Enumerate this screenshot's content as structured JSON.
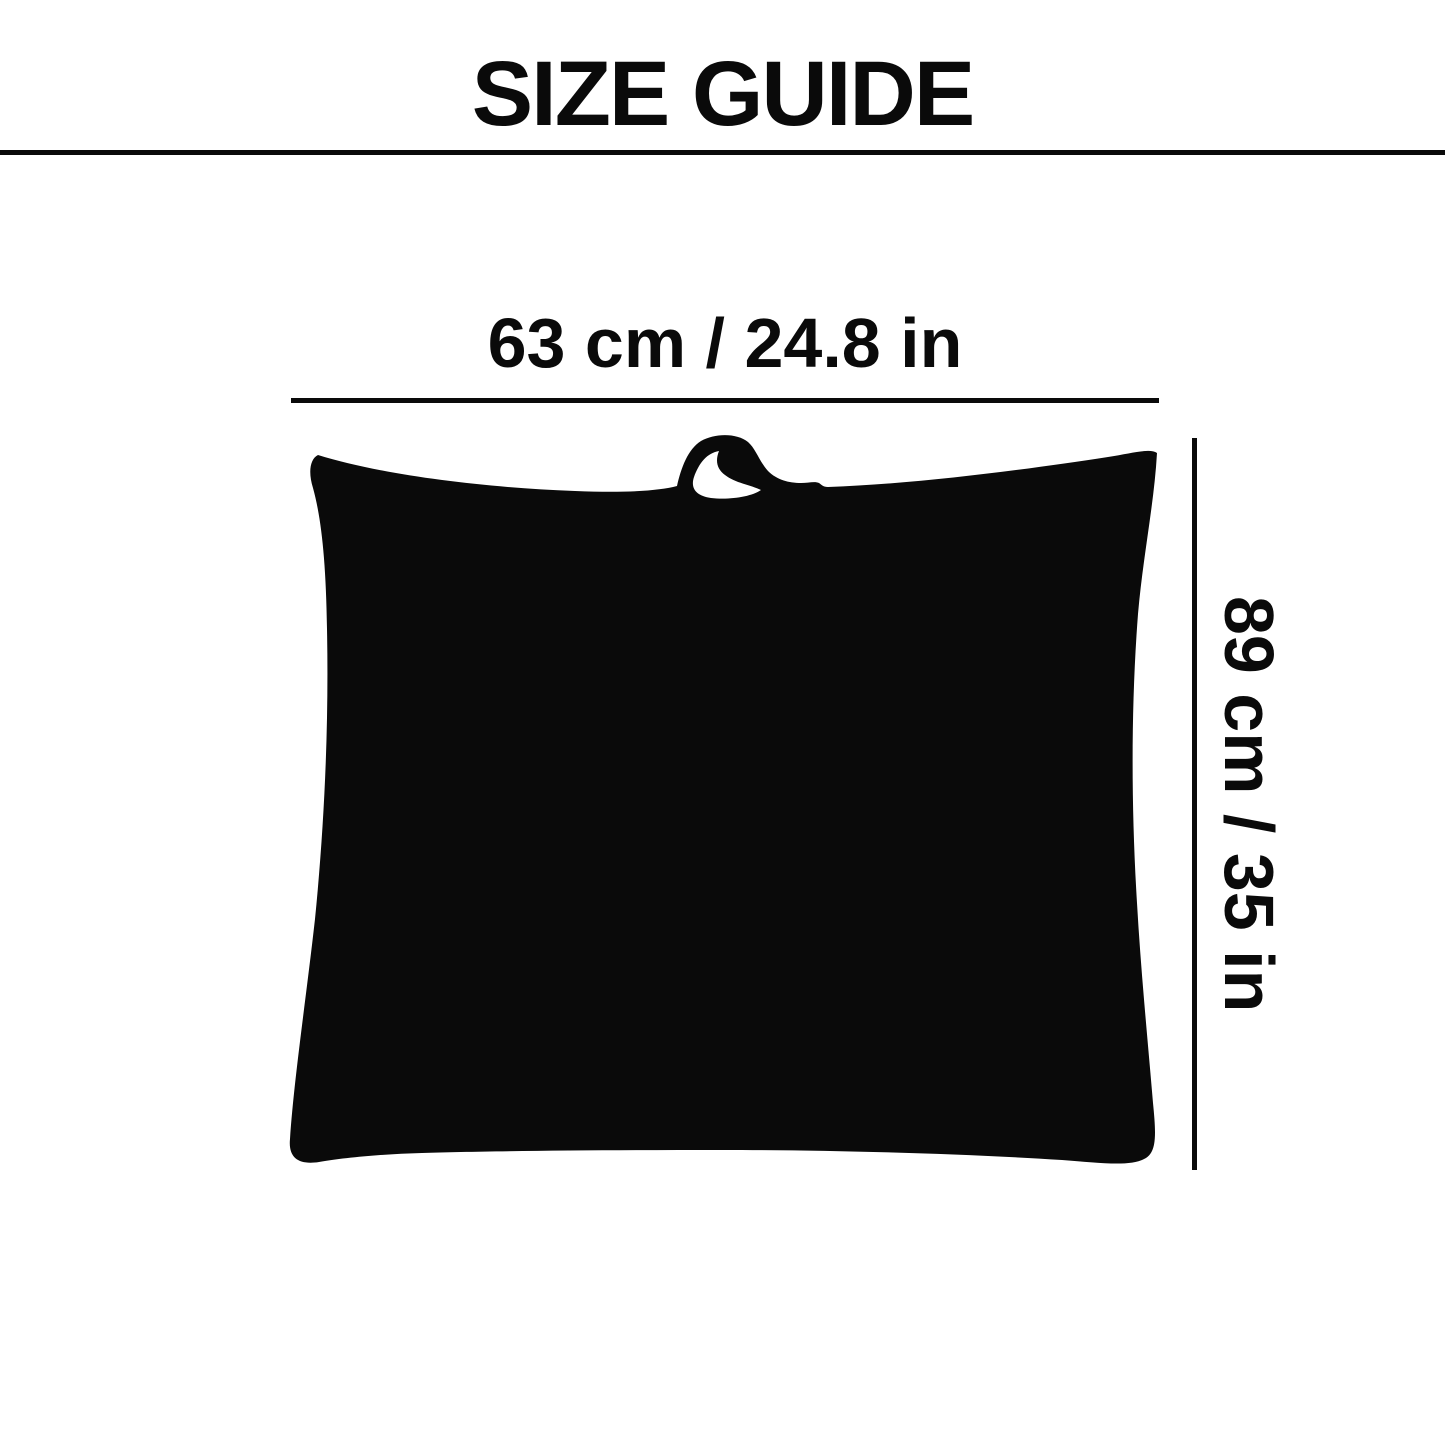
{
  "page": {
    "title": "SIZE GUIDE",
    "background_color": "#ffffff",
    "ink_color": "#0a0a0a"
  },
  "diagram": {
    "silhouette_name": "pillow-storage-bag-with-handle",
    "width": {
      "label": "63 cm / 24.8 in",
      "cm": 63,
      "in": 24.8
    },
    "height": {
      "label": "89 cm / 35 in",
      "cm": 89,
      "in": 35
    }
  }
}
